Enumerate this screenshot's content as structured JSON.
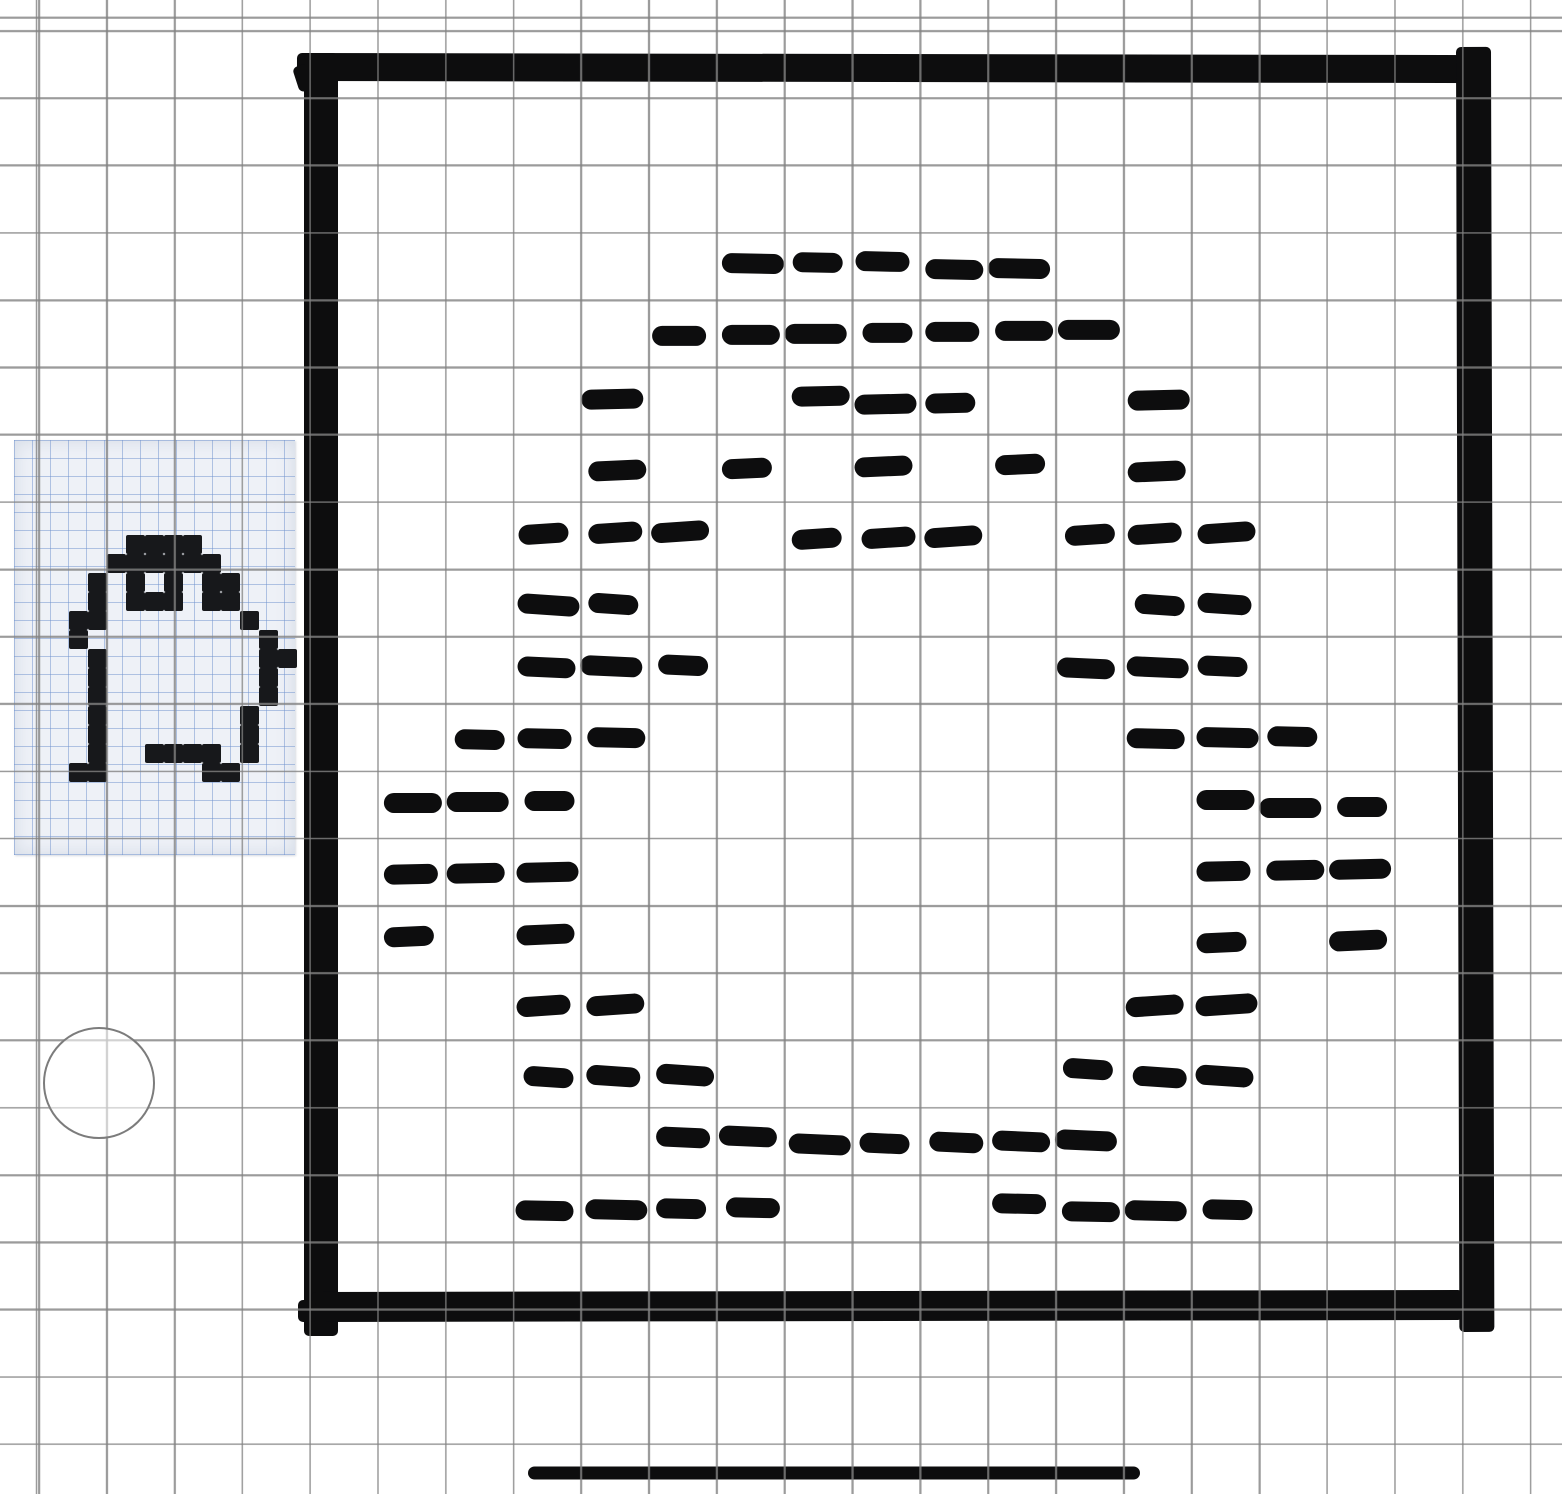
{
  "app": {
    "kind": "drawing-canvas",
    "canvas_w": 1562,
    "canvas_h": 1494,
    "background": "#ffffff",
    "ink_color": "#0d0d0e"
  },
  "grid": {
    "cell_w": 67.8,
    "cell_h": 67.3,
    "offset_x": 38,
    "offset_y": 30,
    "line_color": "#828282"
  },
  "frame": {
    "comment": "hand-drawn thick square border strokes",
    "bars": [
      {
        "name": "frame-top",
        "x": 297,
        "y": 53,
        "w": 1194,
        "h": 28,
        "tilt": 0.1
      },
      {
        "name": "frame-left",
        "x": 304,
        "y": 53,
        "w": 34,
        "h": 1283,
        "tilt": 0
      },
      {
        "name": "frame-right",
        "x": 1456,
        "y": 47,
        "w": 35,
        "h": 1285,
        "tilt": -0.15
      },
      {
        "name": "frame-bottom",
        "x": 311,
        "y": 1292,
        "w": 1152,
        "h": 30,
        "tilt": -0.1
      }
    ],
    "ticks": [
      {
        "name": "frame-corner-tick-topleft",
        "x": 292,
        "y": 68,
        "w": 15,
        "h": 26,
        "tilt": -18
      },
      {
        "name": "frame-corner-tick-bottomleft",
        "x": 298,
        "y": 1300,
        "w": 18,
        "h": 22,
        "tilt": 0
      }
    ]
  },
  "chart_data": {
    "type": "heatmap",
    "title": "dashed penguin outline drawn on grid (one dash per grid cell)",
    "rows": [
      {
        "row": 3,
        "cells": [
          10,
          11,
          12,
          13,
          14
        ]
      },
      {
        "row": 4,
        "cells": [
          9,
          10,
          11,
          12,
          13,
          14,
          15
        ]
      },
      {
        "row": 5,
        "cells": [
          8,
          11,
          12,
          13,
          16
        ]
      },
      {
        "row": 6,
        "cells": [
          8,
          10,
          12,
          14,
          16
        ]
      },
      {
        "row": 7,
        "cells": [
          7,
          8,
          9,
          11,
          12,
          13,
          15,
          16,
          17
        ]
      },
      {
        "row": 8,
        "cells": [
          7,
          8,
          16,
          17
        ]
      },
      {
        "row": 9,
        "cells": [
          7,
          8,
          9,
          15,
          16,
          17
        ]
      },
      {
        "row": 10,
        "cells": [
          6,
          7,
          8,
          16,
          17,
          18
        ]
      },
      {
        "row": 11,
        "cells": [
          5,
          6,
          7,
          17,
          18,
          19
        ]
      },
      {
        "row": 12,
        "cells": [
          5,
          6,
          7,
          17,
          18,
          19
        ]
      },
      {
        "row": 13,
        "cells": [
          5,
          7,
          17,
          19
        ]
      },
      {
        "row": 14,
        "cells": [
          7,
          8,
          16,
          17
        ]
      },
      {
        "row": 15,
        "cells": [
          7,
          8,
          9,
          15,
          16,
          17
        ]
      },
      {
        "row": 16,
        "cells": [
          9,
          10,
          11,
          12,
          13,
          14,
          15
        ]
      },
      {
        "row": 17,
        "cells": [
          7,
          8,
          9,
          10,
          14,
          15,
          16,
          17
        ]
      }
    ],
    "dash": {
      "height": 20,
      "base_width": 50,
      "corner_radius": 10
    }
  },
  "reference_image": {
    "x": 14,
    "y": 440,
    "w": 281,
    "h": 415,
    "bg": "#eef1f7",
    "blue_grid_color": "#7aa0d0",
    "pixel_color": "#17181b",
    "pixel_size": 19,
    "origin_x": 55,
    "origin_y": 95,
    "sprite": [
      "...####.....",
      "..######....",
      ".#.#.#.##...",
      ".#.###.##...",
      "##.......#..",
      "#.........#.",
      ".#........##",
      ".#........#.",
      ".#........#.",
      ".#.......#..",
      ".#.......#..",
      ".#..####.#..",
      "##.....##..."
    ]
  },
  "circle_shape": {
    "cx": 99,
    "cy": 1083,
    "r": 55,
    "stroke": "#7c7c7c",
    "stroke_w": 2,
    "fill": "#ffffff",
    "fill_opacity": 0.55
  },
  "bottom_line": {
    "x1": 528,
    "x2": 1140,
    "y": 1473,
    "thickness": 13
  }
}
